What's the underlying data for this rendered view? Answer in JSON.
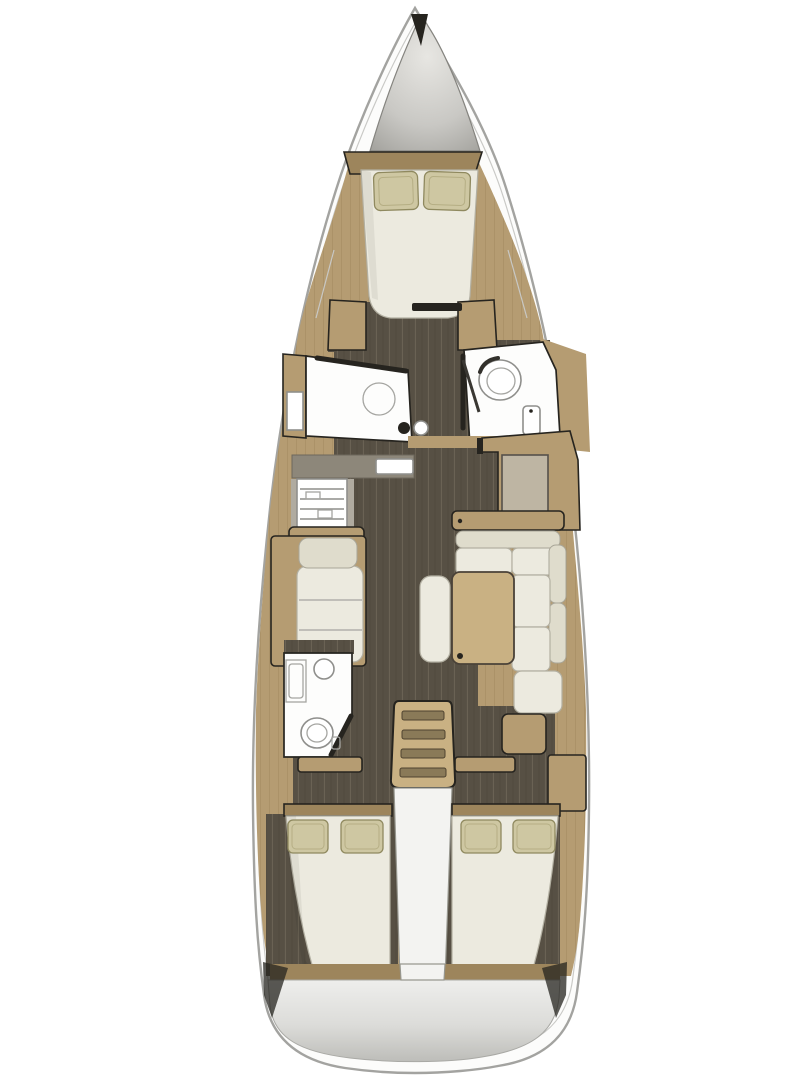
{
  "plan": {
    "type": "sailboat-interior-floor-plan",
    "orientation": "bow-up",
    "rooms": [
      "anchor-locker",
      "forward-cabin",
      "shower-room-port",
      "head-starboard",
      "galley-port",
      "chart-table-starboard",
      "salon",
      "aft-head-port",
      "companionway-stairs",
      "aft-cabin-port",
      "aft-cabin-starboard",
      "transom"
    ],
    "furniture": [
      "v-berth-double-bed",
      "pillows",
      "shower-ring",
      "toilet",
      "washbasin",
      "stove",
      "sink",
      "settee",
      "l-shaped-sofa",
      "saloon-table",
      "bench",
      "chart-desk",
      "double-bed-port",
      "double-bed-starboard"
    ]
  },
  "colors": {
    "bg": "#ffffff",
    "hull_fill": "#fcfcfb",
    "hull_stroke": "#a3a3a0",
    "wood": "#b59c72",
    "wood_dark": "#9d855c",
    "wood_light": "#c9b183",
    "floor": "#575044",
    "plank": "#6c6455",
    "cushion": "#eceadf",
    "cushion_shade": "#dfdccc",
    "pillow": "#cec7a2",
    "room": "#fdfdfc",
    "counter": "#8d877a",
    "desk": "#beb5a3",
    "metal_light": "#e7e6e2",
    "metal_dark": "#9b9a95",
    "transom_light": "#eeeeec",
    "transom_dark": "#bdbdb9",
    "line_dark": "#26241f"
  }
}
